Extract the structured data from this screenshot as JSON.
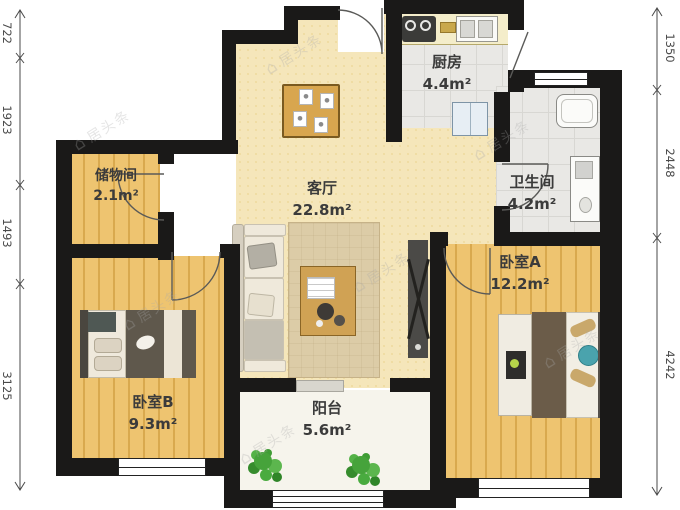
{
  "plan_title": "apartment-floor-plan",
  "rooms": {
    "living": {
      "name": "客厅",
      "area": "22.8m²"
    },
    "kitchen": {
      "name": "厨房",
      "area": "4.4m²"
    },
    "bathroom": {
      "name": "卫生间",
      "area": "4.2m²"
    },
    "bedroom_a": {
      "name": "卧室A",
      "area": "12.2m²"
    },
    "bedroom_b": {
      "name": "卧室B",
      "area": "9.3m²"
    },
    "storage": {
      "name": "储物间",
      "area": "2.1m²"
    },
    "balcony": {
      "name": "阳台",
      "area": "5.6m²"
    }
  },
  "dimensions": {
    "left": [
      {
        "value": "722"
      },
      {
        "value": "1923"
      },
      {
        "value": "1493"
      },
      {
        "value": "3125"
      }
    ],
    "right": [
      {
        "value": "1350"
      },
      {
        "value": "2448"
      },
      {
        "value": "4242"
      }
    ]
  },
  "watermark": {
    "icon": "⌂",
    "text": "居头条"
  },
  "colors": {
    "wall": "#1a1918",
    "wood_floor": "#eec470",
    "living_floor": "#f5e6ba",
    "tile_floor": "#e9e8e5",
    "plant": "#46a33b",
    "accent_teal": "#4aa3ad"
  }
}
